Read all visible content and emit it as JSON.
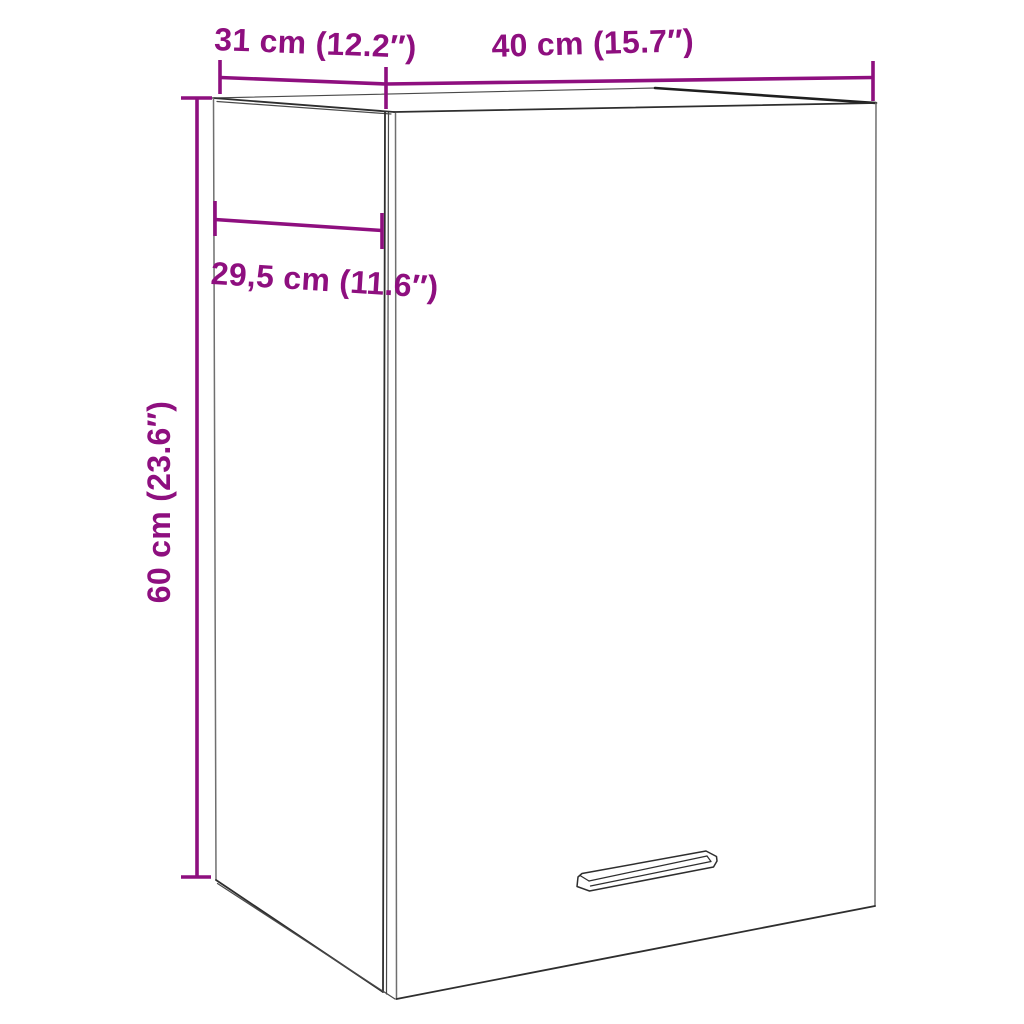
{
  "page": {
    "type": "furniture-dimension-diagram",
    "product": "wall-mounted cabinet",
    "background": "#ffffff"
  },
  "colors": {
    "dimension_accent": "#8e0f7f",
    "outline_dark": "#2e2e2e",
    "outline_light": "#6f6f6f"
  },
  "dimensions": {
    "top_depth": {
      "label": "31 cm (12.2″)",
      "cm": "31",
      "inches": "12.2"
    },
    "top_width": {
      "label": "40 cm (15.7″)",
      "cm": "40",
      "inches": "15.7"
    },
    "inner_depth": {
      "label": "29,5 cm (11.6″)",
      "cm": "29,5",
      "inches": "11.6"
    },
    "height": {
      "label": "60 cm (23.6″)",
      "cm": "60",
      "inches": "23.6"
    }
  }
}
